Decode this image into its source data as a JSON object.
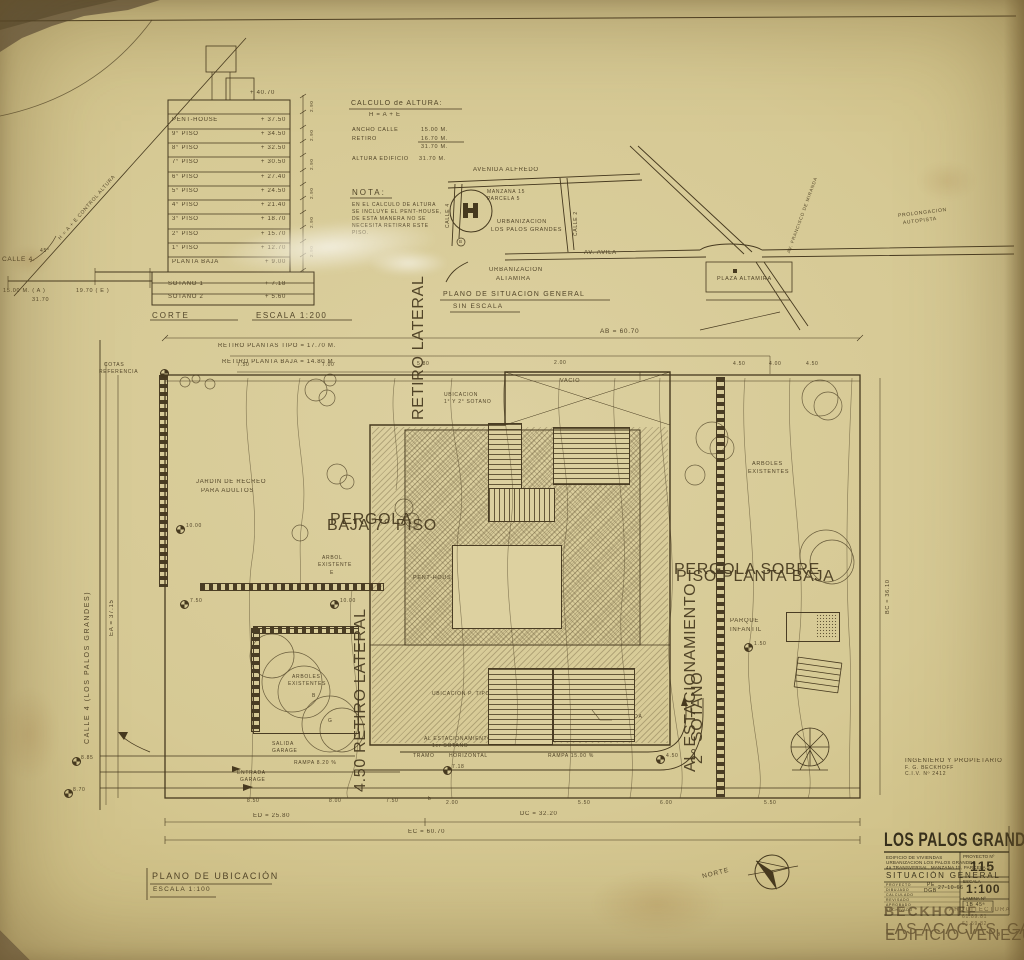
{
  "corte": {
    "title": "CORTE",
    "scale": "ESCALA 1:200",
    "top_elev": "+ 40.70",
    "tick_value": "2.90",
    "floors": [
      {
        "label": "PENT-HOUSE",
        "elev": "+ 37.50"
      },
      {
        "label": "9° PISO",
        "elev": "+ 34.50"
      },
      {
        "label": "8° PISO",
        "elev": "+ 32.50"
      },
      {
        "label": "7° PISO",
        "elev": "+ 30.50"
      },
      {
        "label": "6° PISO",
        "elev": "+ 27.40"
      },
      {
        "label": "5° PISO",
        "elev": "+ 24.50"
      },
      {
        "label": "4° PISO",
        "elev": "+ 21.40"
      },
      {
        "label": "3° PISO",
        "elev": "+ 18.70"
      },
      {
        "label": "2° PISO",
        "elev": "+ 15.70"
      },
      {
        "label": "1° PISO",
        "elev": "+ 12.70"
      },
      {
        "label": "PLANTA BAJA",
        "elev": "+ 9.00"
      },
      {
        "label": "SOTANO 1",
        "elev": "+ 7.18"
      },
      {
        "label": "SOTANO 2",
        "elev": "+ 5.60"
      }
    ],
    "street": "CALLE 4.",
    "dim_a": "15.00 M. ( A )",
    "dim_e": "19.70  ( E )",
    "dim_total": "31.70",
    "diag_note": "H = A + E   CONTROL ALTURA",
    "angle": "45°"
  },
  "calculo": {
    "title": "CALCULO de ALTURA:",
    "formula": "H =  A + E",
    "ancho_label": "ANCHO CALLE",
    "ancho": "15.00  M.",
    "retiro_label": "RETIRO",
    "retiro": "16.70  M.",
    "suma": "31.70  M.",
    "altura_label": "ALTURA EDIFICIO",
    "altura": "31.70  M."
  },
  "nota": {
    "title": "NOTA:",
    "lines": [
      "EN EL CALCULO DE ALTURA",
      "SE INCLUYE EL PENT-HOUSE,",
      "DE ESTA MANERA NO SE",
      "NECESITA RETIRAR ESTE",
      "PISO."
    ]
  },
  "situacion": {
    "caption1": "PLANO DE SITUACION GENERAL",
    "caption2": "SIN ESCALA",
    "avenida": "AVENIDA ALFREDO",
    "manzana": "MANZANA 15",
    "parcela": "PARCELA 5",
    "calle4": "CALLE 4",
    "calle2": "CALLE 2",
    "urb1a": "URBANIZACION",
    "urb1b": "LOS PALOS GRANDES",
    "avila": "AV. AVILA",
    "urb2a": "URBANIZACION",
    "urb2b": "ALTAMIRA",
    "plaza": "PLAZA ALTAMIRA",
    "miranda": "AV. FRANCISCO DE MIRANDA",
    "autopista1": "PROLONGACION",
    "autopista2": "AUTOPISTA",
    "b_marker": "B"
  },
  "plan": {
    "caption1": "PLANO DE UBICACIÓN",
    "caption2": "ESCALA  1:100",
    "norte": "NORTE",
    "dim_ab": "AB = 60.70",
    "dim_ed": "ED = 25.80",
    "dim_ec": "EC = 60.70",
    "dim_dc": "DC = 32.20",
    "dim_ea": "EA = 37.15",
    "dim_bc": "BC = 36.10",
    "street": "CALLE 4  (LOS PALOS GRANDES)",
    "retiro_tipo": "RETIRO PLANTAS TIPO = 17.70 M.",
    "retiro_baja": "RETIRO PLANTA BAJA = 14.80 M.",
    "cotas1": "COTAS",
    "cotas2": "REFERENCIA",
    "vacio": "VACIO",
    "ubic_sotano1": "UBICACION",
    "ubic_sotano2": "1° Y 2° SOTANO",
    "retiro_lateral_top": "RETIRO LATERAL",
    "retiro_lateral_bot": "4.50   RETIRO LATERAL",
    "jardin1": "JARDIN DE RECREO",
    "jardin2": "PARA ADULTOS",
    "pergola1a": "PERGOLA",
    "pergola1b": "BAJA 7° PISO",
    "arbol1": "ARBOL",
    "arbol2": "EXISTENTE",
    "arbol_tag": "E",
    "tag_b": "B",
    "tag_g": "G",
    "penthouse": "PENT-HOUSE",
    "sala": "SALA DE MAQUINAS",
    "pergola2a": "PERGOLA SOBRE",
    "pergola2b": "PISO PLANTA BAJA",
    "arboles_r1": "ARBOLES",
    "arboles_r2": "EXISTENTES",
    "parque1": "PARQUE",
    "parque2": "INFANTIL",
    "ubic_tipo": "UBICACION  P. TIPO",
    "al_est1a": "AL ESTACIONAMIENTO",
    "al_est1b": "1er  SOTANO",
    "tramo": "TRAMO",
    "horizontal": "HORIZONTAL",
    "rampa15": "RAMPA  15.00 %",
    "fachada": "FACHADA",
    "al_est2a": "AL ESTACIONAMIENTO",
    "al_est2b": "2° SOTANO",
    "arboles_bl1": "ARBOLES",
    "arboles_bl2": "EXISTENTES",
    "salida1": "SALIDA",
    "salida2": "GARAGE",
    "rampa82": "RAMPA  8.20 %",
    "entrada1": "ENTRADA",
    "entrada2": "GARAGE",
    "corner_b": "b"
  },
  "plan_numbers": {
    "top": [
      "7.50",
      "7.00",
      "5.80",
      "2.00",
      "4.50",
      "4.00",
      "4.50"
    ],
    "bottom": [
      "8.50",
      "8.00",
      "7.50",
      "2.00",
      "5.50",
      "6.00",
      "5.50"
    ],
    "spots": [
      "10.00",
      "7.50",
      "10.00",
      "1.50",
      "4.50",
      "7.18",
      "8.85",
      "8.70"
    ]
  },
  "engineer": {
    "line1": "INGENIERO Y PROPIETARIO",
    "line2": "F. G. BECKHOFF",
    "line3": "C.I.V.  Nº 2412"
  },
  "title_block": {
    "title": "LOS PALOS GRANDES",
    "sub1": "EDIFICIO DE VIVIENDAS",
    "sub2": "URBANIZACION LOS PALOS GRANDES",
    "sub3": "4a TRANSVERSAL, MANZANA 15, PARCELA 5",
    "drawing_name": "SITUACIÓN GENERAL",
    "proyecto_label": "PROYECTO Nº",
    "proyecto_no": "115",
    "escala_label": "ESCALA",
    "escala": "1:100",
    "lamina_label": "LAMINA Nº",
    "lamina": "1B  45ª",
    "row_labels": [
      "PROYECTO",
      "DIBUJADO",
      "CALCULADO",
      "REVISADO",
      "APROBADO",
      "ARCHIVADO"
    ],
    "val1": "PE",
    "val2": "DGB",
    "fecha": "27-10-66",
    "firm": "BECKHOFF",
    "firm_type": "ARQUITECTURA",
    "tel1": "61.89.81",
    "tel2": "61.59.82",
    "addr1": "LAS ACACIAS, CALLE CHILE",
    "addr2": "EDIFICIO VENEZUELA"
  }
}
